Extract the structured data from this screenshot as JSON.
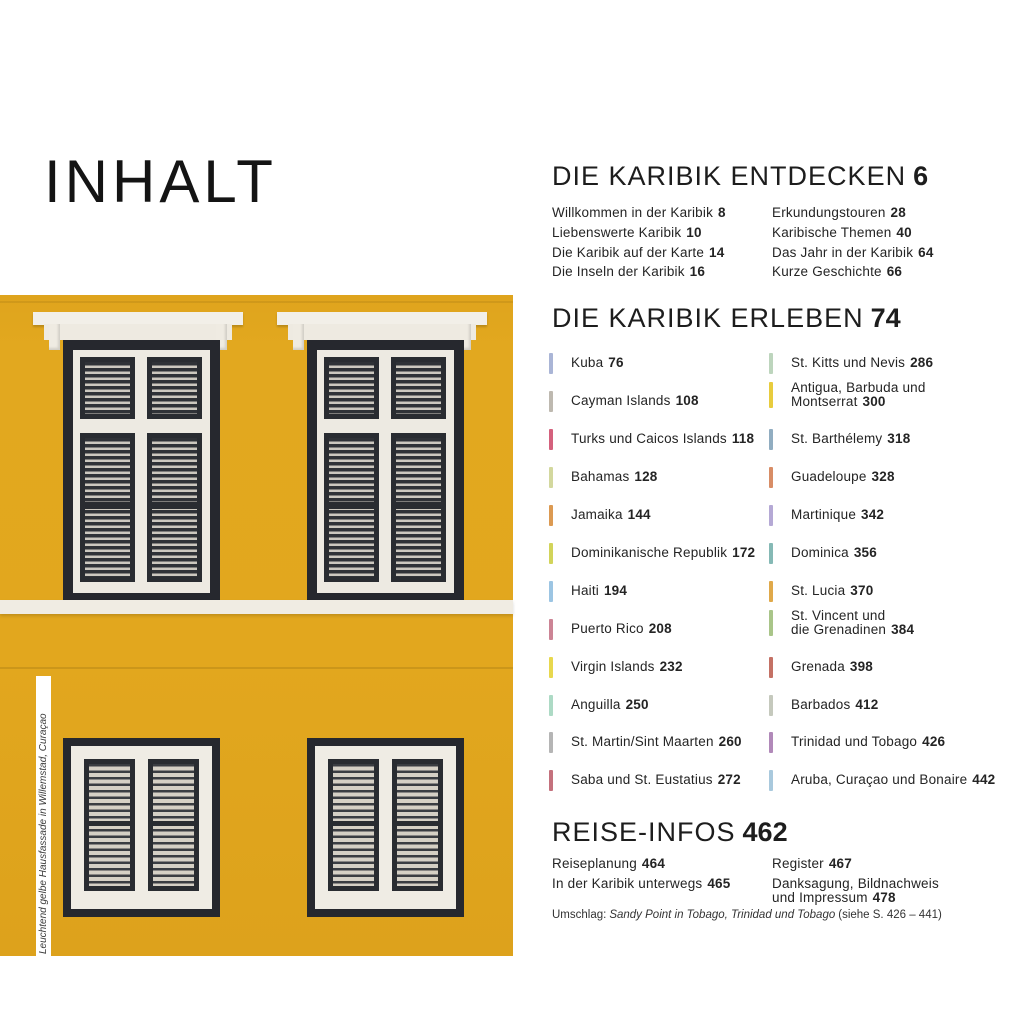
{
  "page_title": "INHALT",
  "photo": {
    "caption": "Leuchtend gelbe Hausfassade in Willemstad, Curaçao",
    "wall_color": "#e2a71e"
  },
  "sections": {
    "entdecken": {
      "title": "DIE KARIBIK ENTDECKEN",
      "page": "6",
      "col1": [
        {
          "label": "Willkommen in der Karibik",
          "page": "8"
        },
        {
          "label": "Liebenswerte Karibik",
          "page": "10"
        },
        {
          "label": "Die Karibik auf der Karte",
          "page": "14"
        },
        {
          "label": "Die Inseln der Karibik",
          "page": "16"
        }
      ],
      "col2": [
        {
          "label": "Erkundungstouren",
          "page": "28"
        },
        {
          "label": "Karibische Themen",
          "page": "40"
        },
        {
          "label": "Das Jahr in der Karibik",
          "page": "64"
        },
        {
          "label": "Kurze Geschichte",
          "page": "66"
        }
      ]
    },
    "erleben": {
      "title": "DIE KARIBIK ERLEBEN",
      "page": "74",
      "col1": [
        {
          "label": "Kuba",
          "page": "76",
          "color": "#aab5d6"
        },
        {
          "label": "Cayman Islands",
          "page": "108",
          "color": "#beb9b0"
        },
        {
          "label": "Turks und Caicos Islands",
          "page": "118",
          "color": "#d4617d"
        },
        {
          "label": "Bahamas",
          "page": "128",
          "color": "#d3d89e"
        },
        {
          "label": "Jamaika",
          "page": "144",
          "color": "#dc9a52"
        },
        {
          "label": "Dominikanische Republik",
          "page": "172",
          "color": "#d2d45a"
        },
        {
          "label": "Haiti",
          "page": "194",
          "color": "#9cc5e3"
        },
        {
          "label": "Puerto Rico",
          "page": "208",
          "color": "#cc8495"
        },
        {
          "label": "Virgin Islands",
          "page": "232",
          "color": "#e8d84e"
        },
        {
          "label": "Anguilla",
          "page": "250",
          "color": "#addac5"
        },
        {
          "label": "St. Martin/Sint Maarten",
          "page": "260",
          "color": "#b5b5b5"
        },
        {
          "label": "Saba und St. Eustatius",
          "page": "272",
          "color": "#c4717d"
        }
      ],
      "col2": [
        {
          "label": "St. Kitts und Nevis",
          "page": "286",
          "color": "#bdd5bd"
        },
        {
          "label": "Antigua, Barbuda und\nMontserrat",
          "page": "300",
          "color": "#e8cc3e"
        },
        {
          "label": "St. Barthélemy",
          "page": "318",
          "color": "#91adc1"
        },
        {
          "label": "Guadeloupe",
          "page": "328",
          "color": "#d88d66"
        },
        {
          "label": "Martinique",
          "page": "342",
          "color": "#b5a9d5"
        },
        {
          "label": "Dominica",
          "page": "356",
          "color": "#85b9b5"
        },
        {
          "label": "St. Lucia",
          "page": "370",
          "color": "#e0a94a"
        },
        {
          "label": "St. Vincent und\ndie Grenadinen",
          "page": "384",
          "color": "#a9c589"
        },
        {
          "label": "Grenada",
          "page": "398",
          "color": "#c47165"
        },
        {
          "label": "Barbados",
          "page": "412",
          "color": "#c5c9bd"
        },
        {
          "label": "Trinidad und Tobago",
          "page": "426",
          "color": "#b189b9"
        },
        {
          "label": "Aruba, Curaçao und Bonaire",
          "page": "442",
          "color": "#a9c9dd"
        }
      ]
    },
    "reiseinfos": {
      "title": "REISE-INFOS",
      "page": "462",
      "col1": [
        {
          "label": "Reiseplanung",
          "page": "464"
        },
        {
          "label": "In der Karibik unterwegs",
          "page": "465"
        }
      ],
      "col2": [
        {
          "label": "Register",
          "page": "467"
        },
        {
          "label": "Danksagung, Bildnachweis\nund Impressum",
          "page": "478"
        }
      ]
    }
  },
  "footer": {
    "prefix": "Umschlag:",
    "cover_title": "Sandy Point in Tobago, Trinidad und Tobago",
    "suffix": "(siehe S. 426 – 441)"
  }
}
